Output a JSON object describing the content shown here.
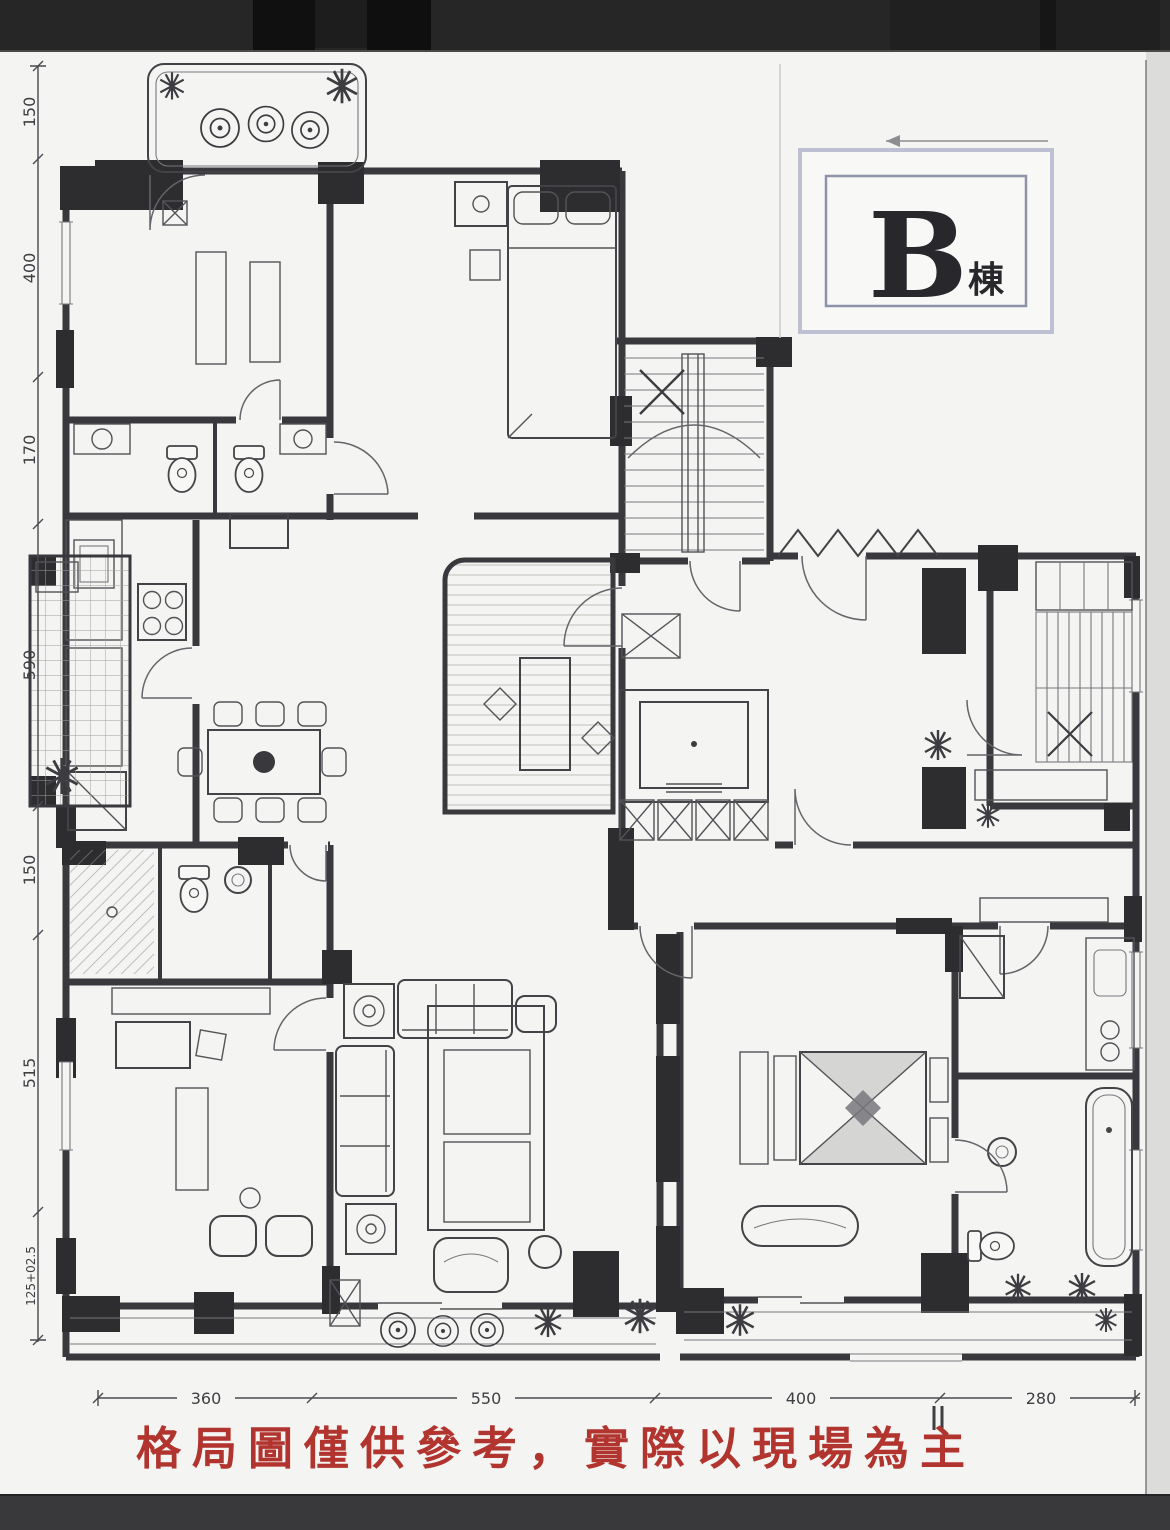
{
  "building_label": {
    "letter": "B",
    "suffix": "棟"
  },
  "disclaimer": {
    "text": "格局圖僅供參考，實際以現場為主",
    "color": "#b2342e"
  },
  "dimensions": {
    "left_labels": [
      "150",
      "400",
      "170",
      "590",
      "150",
      "515",
      "125+02.5"
    ],
    "bottom_labels": [
      "360",
      "550",
      "400",
      "280"
    ]
  },
  "colors": {
    "paper": "#f4f4f2",
    "ink": "#2b2b30",
    "wall_fill": "#1f1f22",
    "dim_text": "#3e3e43",
    "label_box_outer": "#bcc0d2",
    "label_box_inner": "#8d93a8",
    "red_text": "#b2342e",
    "photo_top_bar": "#262626",
    "photo_bottom_bar": "#39393b",
    "photo_side_band": "#dcdcda"
  },
  "icons": {
    "plant-icon": "asterisk-star",
    "planter-icon": "concentric-circles",
    "stairs-icon": "parallel-treads-with-x-rail",
    "elevator-icon": "box-in-box",
    "toilet-icon": "ellipse-with-tank",
    "bathtub-icon": "rounded-rectangle",
    "stove-icon": "four-burner-circles",
    "shaft-icon": "x-box"
  }
}
